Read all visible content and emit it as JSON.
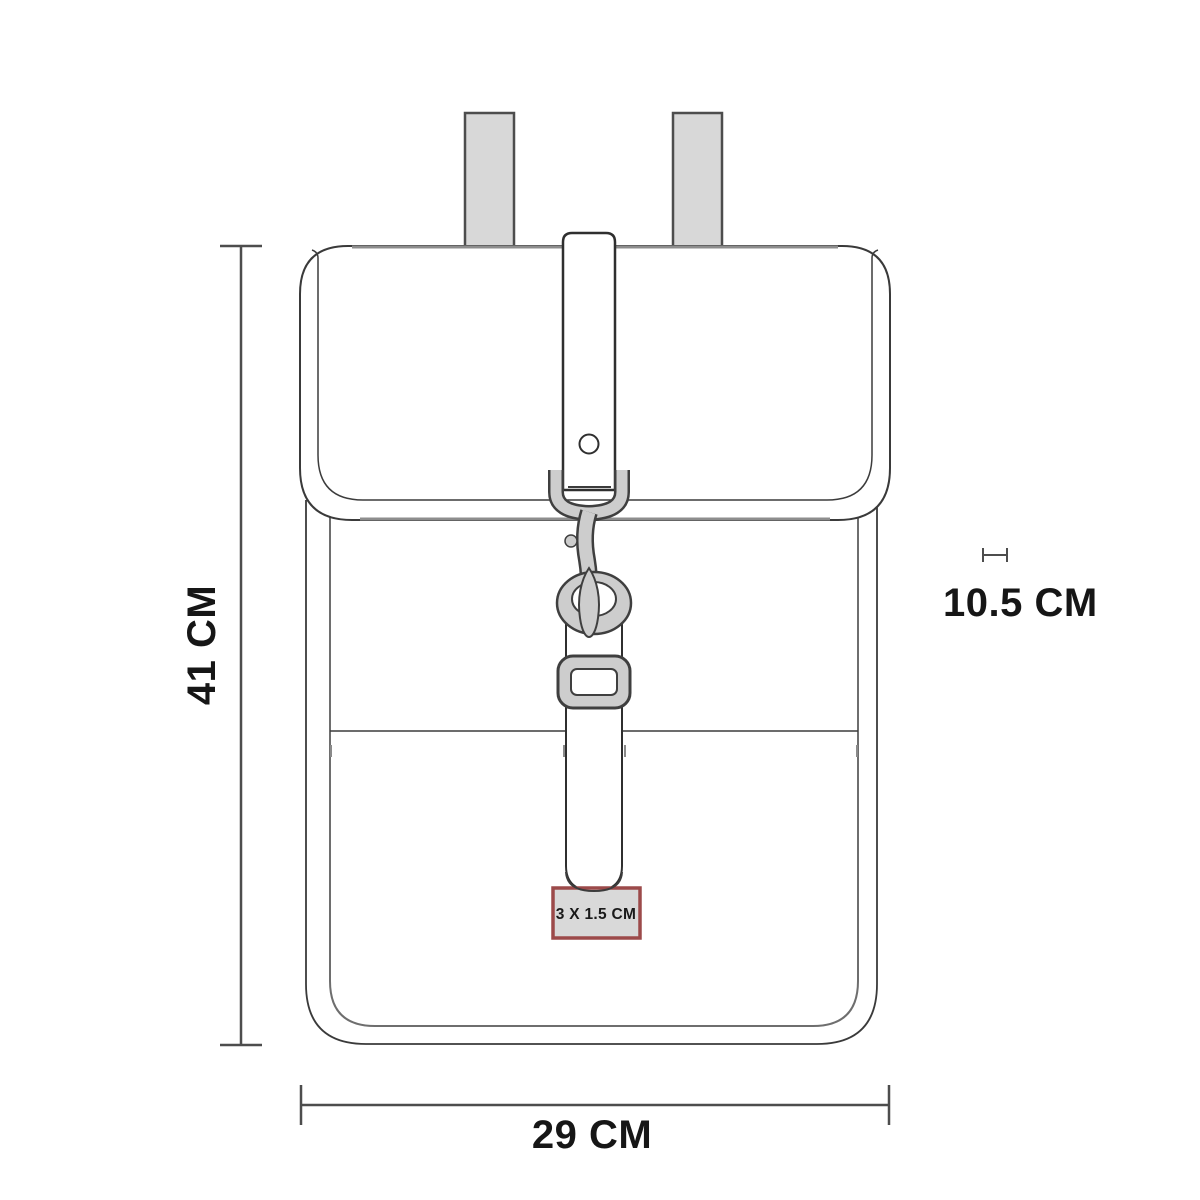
{
  "title": "Backpack measurement diagram",
  "dimensions": {
    "height": {
      "label": "41 CM"
    },
    "width": {
      "label": "29 CM"
    },
    "depth": {
      "label": "10.5 CM"
    }
  },
  "branding_area": {
    "label": "3 X 1.5 CM"
  },
  "parts": [
    "left-shoulder-strap",
    "right-shoulder-strap",
    "flap",
    "body",
    "closure-strap",
    "snap-hook",
    "d-ring",
    "strap-slider",
    "branding-area-box"
  ],
  "colors": {
    "background": "#ffffff",
    "outline": "#3a3a3a",
    "hardware_fill": "#cdcdcd",
    "strap_fill": "#d8d8d8",
    "dimension_line": "#4d4d4d",
    "label_box_fill": "#d9d9d9",
    "label_box_border": "#9c4a4a",
    "text": "#161616"
  }
}
